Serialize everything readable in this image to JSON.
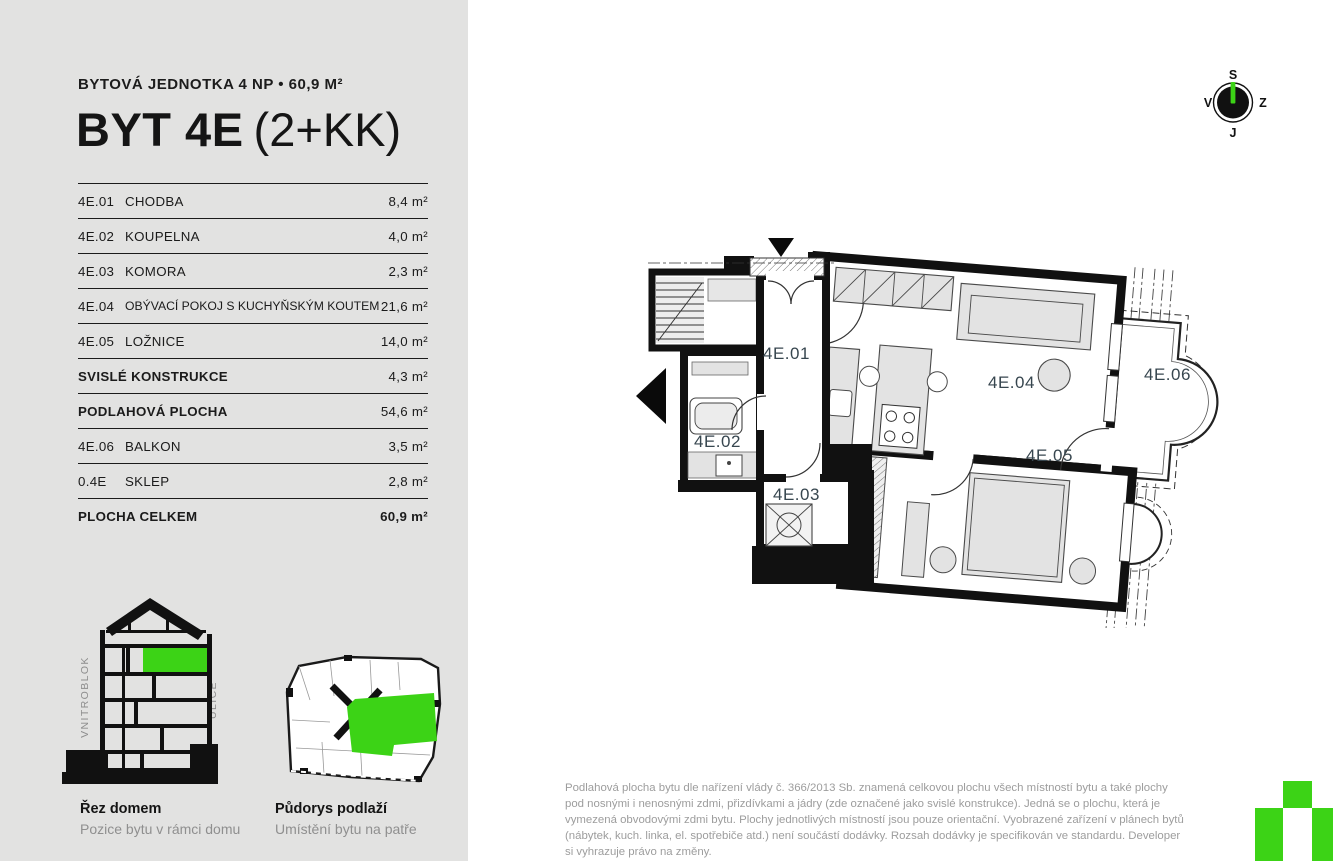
{
  "colors": {
    "accent_green": "#3cd316",
    "sidebar_bg": "#e2e2e1",
    "ink": "#191919",
    "muted_text": "#9d9d9d",
    "plan_label": "#37464f"
  },
  "header": {
    "subtitle": "BYTOVÁ JEDNOTKA 4 NP • 60,9 M²",
    "title_bold": "BYT 4E",
    "title_light": "(2+KK)"
  },
  "area_table": {
    "rows": [
      {
        "code": "4E.01",
        "name": "CHODBA",
        "value": "8,4 m²"
      },
      {
        "code": "4E.02",
        "name": "KOUPELNA",
        "value": "4,0 m²"
      },
      {
        "code": "4E.03",
        "name": "KOMORA",
        "value": "2,3 m²"
      },
      {
        "code": "4E.04",
        "name": "OBÝVACÍ POKOJ S KUCHYŇSKÝM KOUTEM",
        "value": "21,6 m²"
      },
      {
        "code": "4E.05",
        "name": "LOŽNICE",
        "value": "14,0 m²"
      },
      {
        "code": "",
        "name": "SVISLÉ KONSTRUKCE",
        "value": "4,3 m²"
      },
      {
        "code": "",
        "name": "PODLAHOVÁ PLOCHA",
        "value": "54,6 m²"
      },
      {
        "code": "4E.06",
        "name": "BALKON",
        "value": "3,5 m²"
      },
      {
        "code": "0.4E",
        "name": "SKLEP",
        "value": "2,8 m²"
      },
      {
        "code": "",
        "name": "PLOCHA CELKEM",
        "value": "60,9 m²"
      }
    ]
  },
  "floorplan": {
    "labels": {
      "hallway": "4E.01",
      "bathroom": "4E.02",
      "storage": "4E.03",
      "living": "4E.04",
      "bedroom": "4E.05",
      "balcony": "4E.06"
    }
  },
  "compass": {
    "north": "S",
    "east": "Z",
    "south": "J",
    "west": "V"
  },
  "diagrams": {
    "section": {
      "title": "Řez domem",
      "subtitle": "Pozice bytu v rámci domu",
      "label_left": "VNITROBLOK",
      "label_right": "ULICE"
    },
    "floor": {
      "title": "Půdorys podlaží",
      "subtitle": "Umístění bytu na patře"
    }
  },
  "disclaimer": {
    "text": "Podlahová plocha bytu dle nařízení vlády č. 366/2013 Sb. znamená celkovou plochu všech místností bytu a také plochy pod nosnými i nenosnými zdmi, přizdívkami a jádry (zde označené jako svislé konstrukce). Jedná se o plochu, která je vymezená obvodovými zdmi bytu. Plochy jednotlivých místností jsou pouze orientační. Vyobrazené zařízení v plánech bytů (nábytek, kuch. linka, el. spotřebiče atd.) není součástí dodávky. Rozsah dodávky je specifikován ve standardu. Developer si vyhrazuje právo na změny."
  }
}
